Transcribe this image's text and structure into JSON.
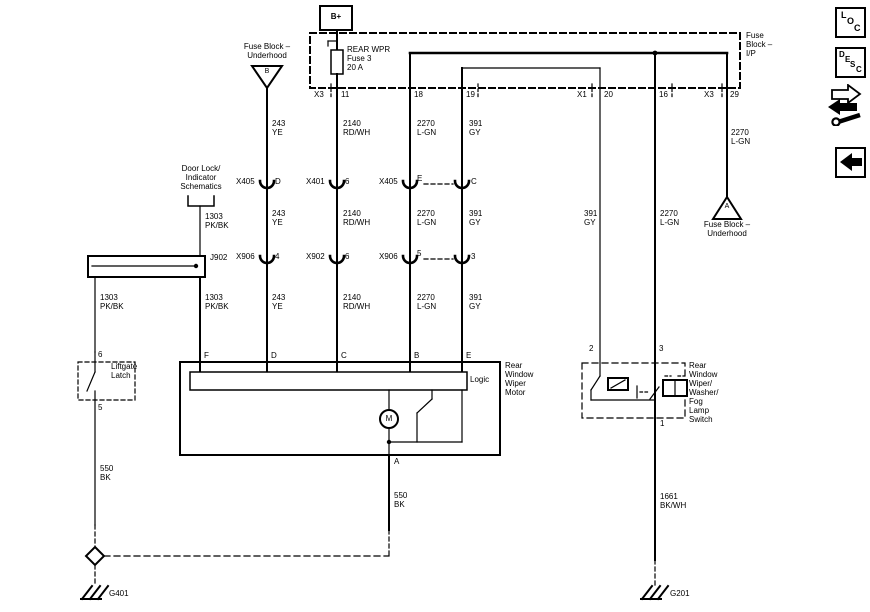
{
  "colors": {
    "ink": "#000000",
    "paper": "#ffffff"
  },
  "battery": {
    "label": "B+"
  },
  "fuse": {
    "name": "REAR WPR",
    "id": "Fuse 3",
    "rating": "20 A"
  },
  "fuse_block_ip": {
    "l1": "Fuse",
    "l2": "Block –",
    "l3": "I/P"
  },
  "top_pins": {
    "x3a": "X3",
    "p11": "11",
    "p18": "18",
    "p19": "19",
    "x1": "X1",
    "p20": "20",
    "p16": "16",
    "x3b": "X3",
    "p29": "29"
  },
  "underhood_b": {
    "l1": "Fuse Block –",
    "l2": "Underhood",
    "id": "B"
  },
  "underhood_a": {
    "l1": "Fuse Block –",
    "l2": "Underhood",
    "id": "A"
  },
  "door_lock_ref": {
    "l1": "Door Lock/",
    "l2": "Indicator",
    "l3": "Schematics"
  },
  "splice": {
    "label": "J902"
  },
  "wires": {
    "w243": {
      "c": "243",
      "col": "YE"
    },
    "w2140": {
      "c": "2140",
      "col": "RD/WH"
    },
    "w2270": {
      "c": "2270",
      "col": "L-GN"
    },
    "w391": {
      "c": "391",
      "col": "GY"
    },
    "w1303": {
      "c": "1303",
      "col": "PK/BK"
    },
    "w550": {
      "c": "550",
      "col": "BK"
    },
    "w1661": {
      "c": "1661",
      "col": "BK/WH"
    }
  },
  "conn_row1": {
    "c1n": "X405",
    "c1p": "D",
    "c2n": "X401",
    "c2p": "6",
    "c3n": "X405",
    "c3p": "E",
    "c4p": "C"
  },
  "conn_row2": {
    "c1n": "X906",
    "c1p": "4",
    "c2n": "X902",
    "c2p": "6",
    "c3n": "X906",
    "c3p": "5",
    "c4p": "3"
  },
  "motor": {
    "l1": "Rear",
    "l2": "Window",
    "l3": "Wiper",
    "l4": "Motor",
    "logic": "Logic",
    "symbol": "M",
    "pins": [
      "F",
      "D",
      "C",
      "B",
      "E"
    ],
    "pin_a": "A"
  },
  "latch": {
    "l1": "Liftgate",
    "l2": "Latch",
    "pin_top": "6",
    "pin_bottom": "5"
  },
  "wiper_switch": {
    "lines": [
      "Rear",
      "Window",
      "Wiper/",
      "Washer/",
      "Fog",
      "Lamp",
      "Switch"
    ],
    "pin2": "2",
    "pin3": "3",
    "pin1": "1"
  },
  "grounds": {
    "g401": "G401",
    "g201": "G201"
  },
  "buttons": {
    "loc": {
      "l1": "L",
      "l2": "O",
      "l3": "C"
    },
    "desc": {
      "l1": "D",
      "l2": "E",
      "l3": "S",
      "l4": "C"
    }
  }
}
